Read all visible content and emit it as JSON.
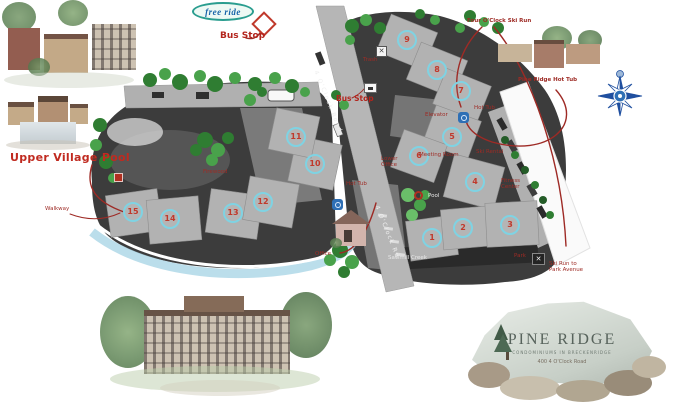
{
  "page_title": "Pine Ridge property site map",
  "logo": {
    "text": "free ride"
  },
  "sign": {
    "title": "PINE RIDGE",
    "subtitle": "CONDOMINIUMS IN BRECKENRIDGE",
    "address": "400 4 O'Clock Road"
  },
  "colors": {
    "marker_ring": "#7fd3e3",
    "marker_number": "#c0392b",
    "label_red": "#9e2b25",
    "map_dark": "#3c3c3c",
    "road_gray": "#b6b6b6",
    "tree_green": "#3f8f43",
    "creek_blue": "#aad6e6",
    "hot_tub_blue": "#2e6fb5",
    "logo_teal": "#2a9d8f"
  },
  "map": {
    "building_markers": [
      {
        "number": "1",
        "x": 432,
        "y": 238
      },
      {
        "number": "2",
        "x": 463,
        "y": 228
      },
      {
        "number": "3",
        "x": 510,
        "y": 225
      },
      {
        "number": "4",
        "x": 475,
        "y": 182
      },
      {
        "number": "5",
        "x": 452,
        "y": 137
      },
      {
        "number": "6",
        "x": 419,
        "y": 156
      },
      {
        "number": "7",
        "x": 461,
        "y": 91
      },
      {
        "number": "8",
        "x": 437,
        "y": 70
      },
      {
        "number": "9",
        "x": 407,
        "y": 40
      },
      {
        "number": "10",
        "x": 315,
        "y": 164
      },
      {
        "number": "11",
        "x": 296,
        "y": 137
      },
      {
        "number": "12",
        "x": 263,
        "y": 202
      },
      {
        "number": "13",
        "x": 233,
        "y": 213
      },
      {
        "number": "14",
        "x": 170,
        "y": 219
      },
      {
        "number": "15",
        "x": 133,
        "y": 212
      }
    ],
    "labels": [
      {
        "id": "bus-stop-top",
        "text": "Bus Stop",
        "x": 220,
        "y": 31,
        "cls": "lbl-bold"
      },
      {
        "id": "four-oclock-ski-run",
        "text": "Four O'Clock Ski Run",
        "x": 467,
        "y": 18,
        "cls": "lbl-tiny"
      },
      {
        "id": "pine-ridge-hot-tub",
        "text": "Pine Ridge Hot Tub",
        "x": 518,
        "y": 77,
        "cls": "lbl-tiny"
      },
      {
        "id": "upper-village-pool",
        "text": "Upper Village Pool",
        "x": 10,
        "y": 152,
        "cls": "lbl-big"
      },
      {
        "id": "walkway",
        "text": "Walkway",
        "x": 45,
        "y": 206,
        "cls": "lbl-micro"
      },
      {
        "id": "bus-stop-mid",
        "text": "Bus Stop",
        "x": 336,
        "y": 95,
        "cls": "lbl-bold-sm"
      },
      {
        "id": "trash",
        "text": "Trash",
        "x": 363,
        "y": 57,
        "cls": "lbl-micro"
      },
      {
        "id": "firewood",
        "text": "Firewood",
        "x": 203,
        "y": 169,
        "cls": "lbl-micro"
      },
      {
        "id": "hot-tub-center",
        "text": "Hot Tub",
        "x": 346,
        "y": 181,
        "cls": "lbl-micro"
      },
      {
        "id": "hot-tub-right",
        "text": "Hot Tub",
        "x": 474,
        "y": 105,
        "cls": "lbl-micro"
      },
      {
        "id": "elevator",
        "text": "Elevator",
        "x": 425,
        "y": 112,
        "cls": "lbl-micro"
      },
      {
        "id": "meeting-room",
        "text": "Meeting Room",
        "x": 419,
        "y": 152,
        "cls": "lbl-micro"
      },
      {
        "id": "ski-rental",
        "text": "Ski Rental",
        "x": 476,
        "y": 149,
        "cls": "lbl-micro"
      },
      {
        "id": "fitness-center",
        "text": "Fitness\nCenter",
        "x": 501,
        "y": 178,
        "cls": "lbl-micro"
      },
      {
        "id": "lower-office",
        "text": "Lower\nOffice",
        "x": 381,
        "y": 156,
        "cls": "lbl-micro"
      },
      {
        "id": "office",
        "text": "Office",
        "x": 315,
        "y": 251,
        "cls": "lbl-micro"
      },
      {
        "id": "pool",
        "text": "Pool",
        "x": 428,
        "y": 193,
        "cls": "lbl-white"
      },
      {
        "id": "sawmill-creek",
        "text": "Sawmill Creek",
        "x": 388,
        "y": 255,
        "cls": "lbl-white"
      },
      {
        "id": "park",
        "text": "Park",
        "x": 514,
        "y": 253,
        "cls": "lbl-micro"
      },
      {
        "id": "ski-run-to-park",
        "text": "Ski Run to\nPark Avenue",
        "x": 549,
        "y": 261,
        "cls": "lbl-micro"
      },
      {
        "id": "road-4-oclock",
        "text": "4 O'Clock Road",
        "x": 318,
        "y": 70,
        "cls": "lbl-road",
        "rotate": 68
      },
      {
        "id": "road-4-oclock-lower",
        "text": "4 O'Clock Rd",
        "x": 379,
        "y": 205,
        "cls": "lbl-road",
        "rotate": 68
      }
    ]
  }
}
